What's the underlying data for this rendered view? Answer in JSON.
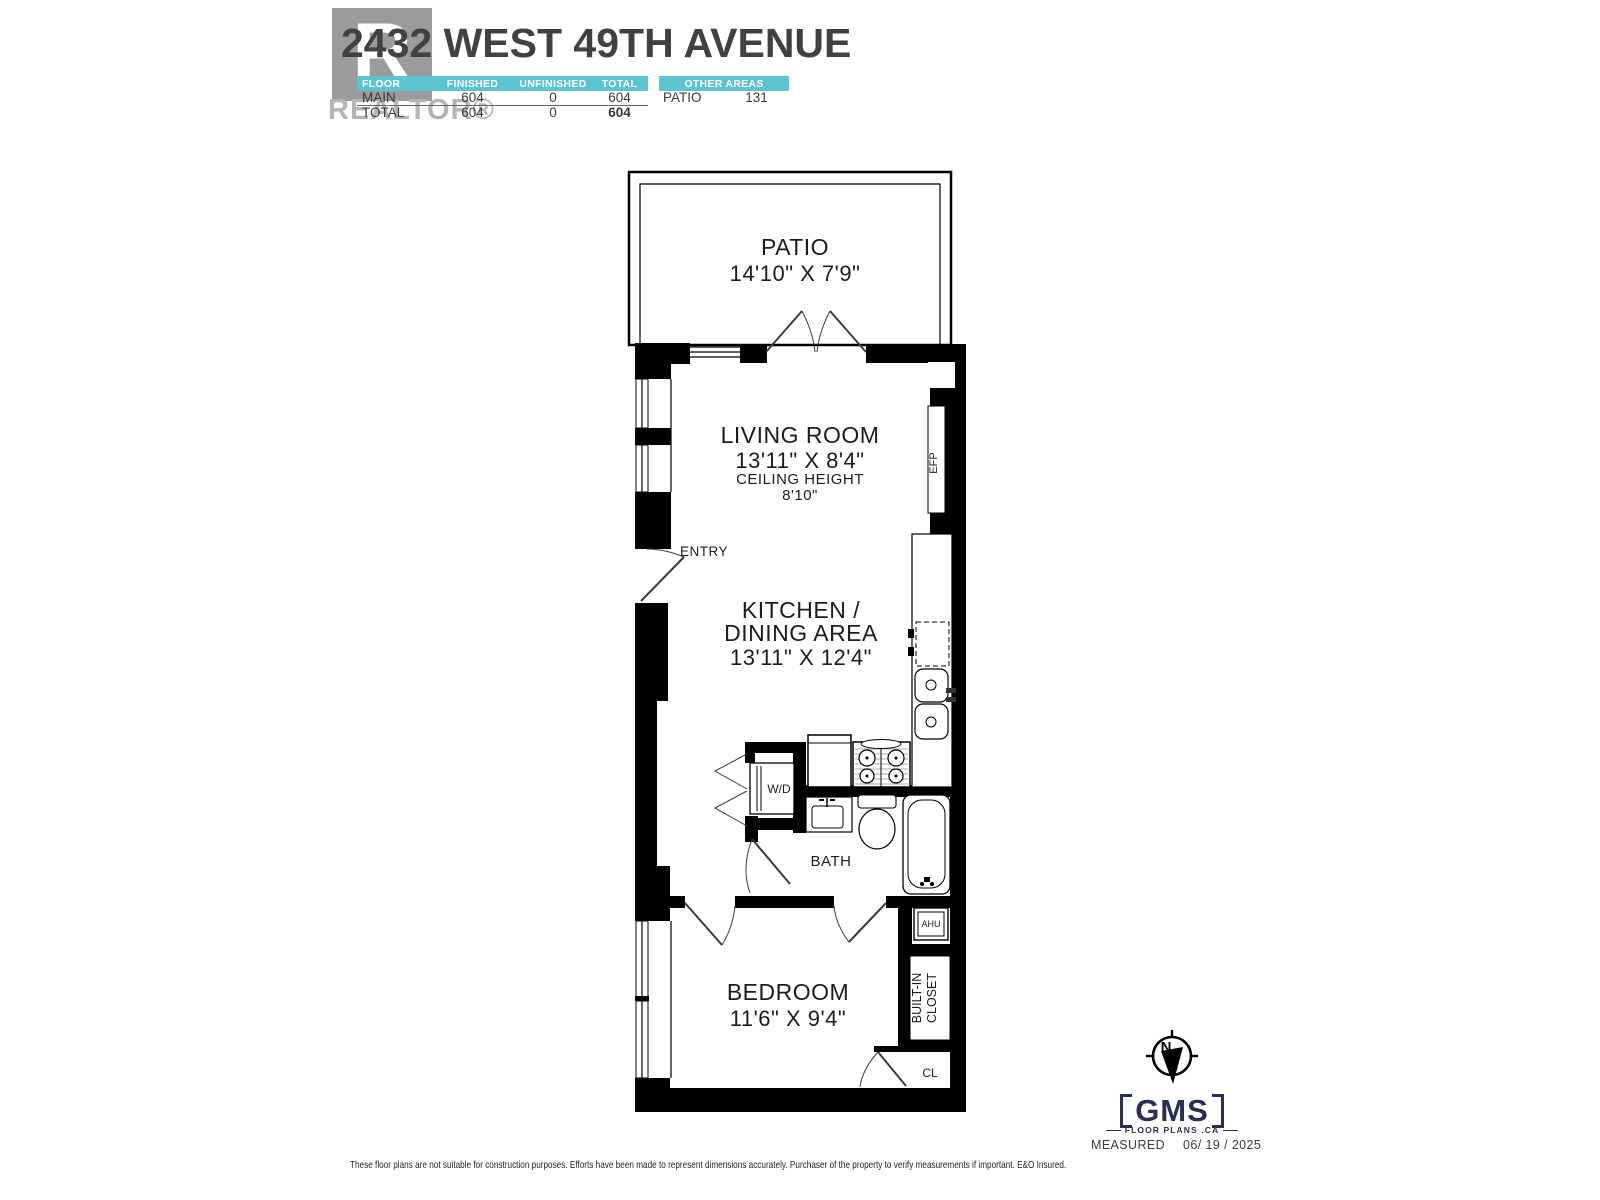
{
  "header": {
    "title": "2432 WEST 49TH AVENUE",
    "watermark": {
      "letter": "R",
      "label": "REALTOR®"
    },
    "accent_color": "#5cc3d1",
    "area_table": {
      "columns": [
        "FLOOR",
        "FINISHED",
        "UNFINISHED",
        "TOTAL"
      ],
      "rows": [
        {
          "floor": "MAIN",
          "finished": "604",
          "unfinished": "0",
          "total": "604"
        },
        {
          "floor": "TOTAL",
          "finished": "604",
          "unfinished": "0",
          "total": "604"
        }
      ]
    },
    "other_areas": {
      "header": "OTHER AREAS",
      "rows": [
        {
          "name": "PATIO",
          "value": "131"
        }
      ]
    }
  },
  "floorplan": {
    "rooms": {
      "patio": {
        "name": "PATIO",
        "dims": "14'10\" X 7'9\""
      },
      "living": {
        "name": "LIVING ROOM",
        "dims": "13'11\" X 8'4\"",
        "ceiling_label": "CEILING HEIGHT",
        "ceiling_value": "8'10\""
      },
      "kitchen": {
        "name_line1": "KITCHEN /",
        "name_line2": "DINING AREA",
        "dims": "13'11\" X 12'4\""
      },
      "bath": {
        "name": "BATH"
      },
      "bedroom": {
        "name": "BEDROOM",
        "dims": "11'6\" X 9'4\""
      }
    },
    "labels": {
      "entry": "ENTRY",
      "efp": "EFP",
      "wd": "W/D",
      "ahu": "AHU",
      "builtin_line1": "BUILT-IN",
      "builtin_line2": "CLOSET",
      "cl": "CL"
    }
  },
  "footer": {
    "logo": {
      "name": "GMS",
      "sub": "FLOOR PLANS .CA",
      "compass_letter": "N",
      "color": "#272f52"
    },
    "measured_label": "MEASURED",
    "measured_date": "06/ 19 / 2025",
    "disclaimer": "These floor plans are not suitable for construction purposes. Efforts have been made to represent dimensions accurately.  Purchaser of the property to verify measurements if important.  E&O Insured."
  }
}
